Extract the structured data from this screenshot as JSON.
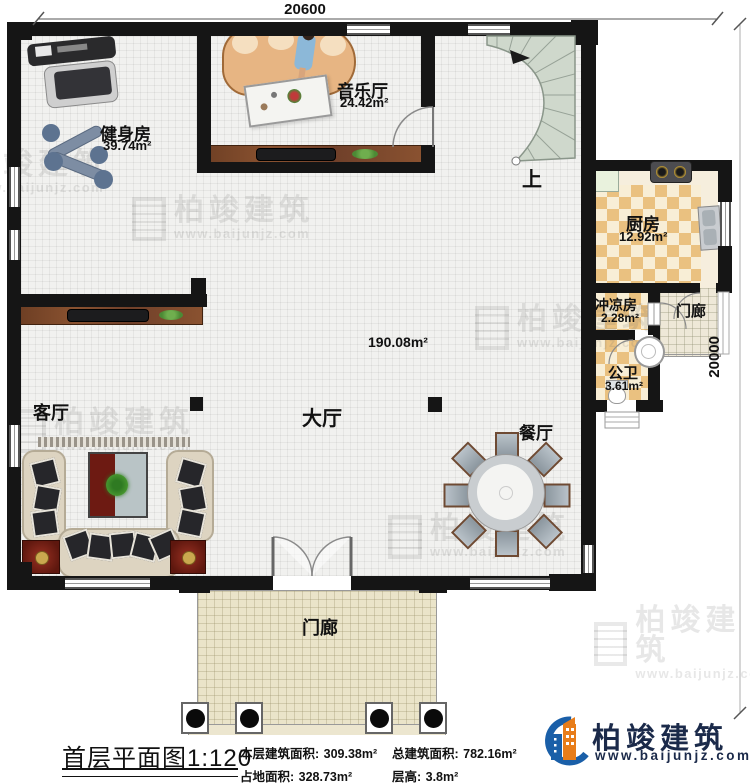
{
  "dimensions": {
    "top": "20600",
    "right": "20000"
  },
  "rooms": {
    "gym": {
      "name": "健身房",
      "area": "39.74m²"
    },
    "music": {
      "name": "音乐厅",
      "area": "24.42m²"
    },
    "kitchen": {
      "name": "厨房",
      "area": "12.92m²"
    },
    "shower": {
      "name": "冲凉房",
      "area": "2.28m²"
    },
    "toilet": {
      "name": "公卫",
      "area": "3.61m²"
    },
    "porch_side": {
      "name": "门廊"
    },
    "porch_front": {
      "name": "门廊"
    },
    "living": {
      "name": "客厅"
    },
    "hall": {
      "name": "大厅",
      "area": "190.08m²"
    },
    "dining": {
      "name": "餐厅"
    },
    "stairs": {
      "label": "上"
    }
  },
  "footer": {
    "title": "首层平面图",
    "scale": "1:120",
    "stats": [
      {
        "label": "本层建筑面积:",
        "value": "309.38m²"
      },
      {
        "label": "总建筑面积:",
        "value": "782.16m²"
      },
      {
        "label": "占地面积:",
        "value": "328.73m²"
      },
      {
        "label": "层高:",
        "value": "3.8m²"
      }
    ]
  },
  "brand": {
    "name": "柏竣建筑",
    "url": "www.baijunjz.com"
  },
  "watermark": {
    "name": "柏竣建筑",
    "url": "www.baijunjz.com"
  },
  "colors": {
    "wall": "#151515",
    "brand_blue": "#1a5fa8",
    "brand_orange": "#e87d1a",
    "stair": "#cfd8cc"
  }
}
